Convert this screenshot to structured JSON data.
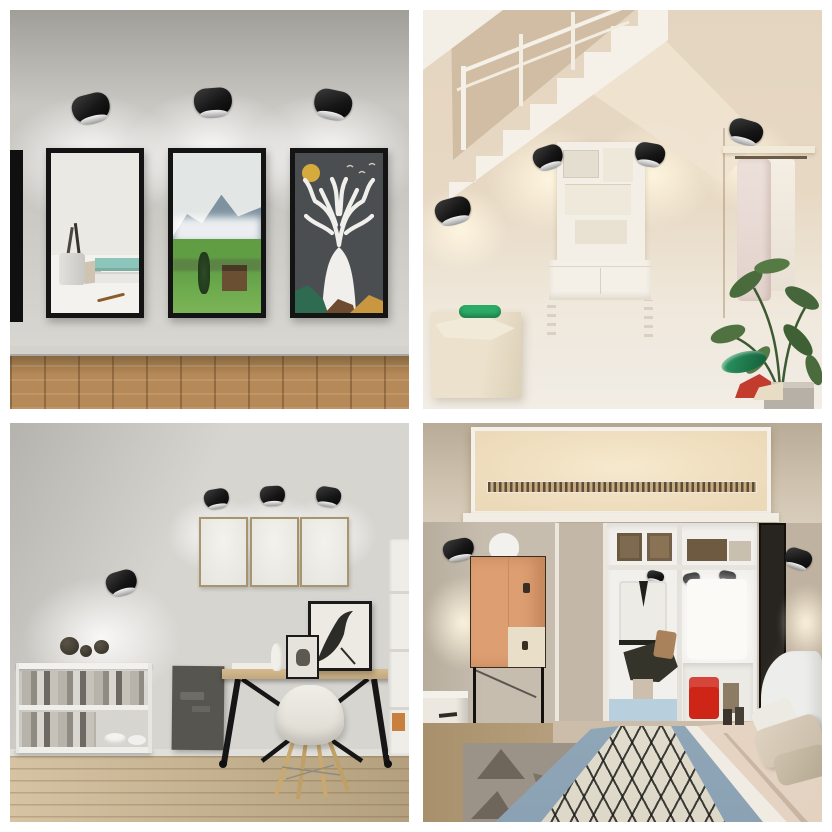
{
  "page": {
    "title": "Wall-mounted black LED spotlights — interior lifestyle photo collage",
    "layout": "2x2 photo grid on white background",
    "text_content": "none — photographic collage with no visible text"
  },
  "palette": {
    "gutter": "#ffffff",
    "frame-black": "#141414",
    "lamp-black": "#161616",
    "q1-wall": "#c9c7c2",
    "q1-wall-light": "#dedcd7",
    "q1-floor": "#b68a58",
    "art1-bg": "#ebe9e4",
    "art1-book-teal": "#8cc5ba",
    "art2-sky": "#e2e6e5",
    "art2-mountain": "#7e92a0",
    "art2-grass": "#61a046",
    "art3-bg": "#4b4e50",
    "art3-deer": "#f0efec",
    "art3-moon": "#d6ab3d",
    "q2-wall": "#e4d5c0",
    "q2-wall-dark": "#d0bda4",
    "q2-stair-white": "#f6f1e8",
    "q2-floor": "#f2ede5",
    "bench-cream": "#ebe1cc",
    "green-cushion": "#2cab66",
    "plant-green": "#4a6c3c",
    "shoe-red": "#c33b2d",
    "q3-wall": "#d7d5d0",
    "q3-frame-border": "#a8946d",
    "q3-floor": "#ccb68f",
    "desk-wood": "#c3a87e",
    "panel-dark": "#56554f",
    "chair-white": "#f0eee8",
    "q4-ceiling-glow": "#f6e9cd",
    "q4-wall-left": "#c6bdaf",
    "closet-white": "#f2f0ec",
    "cabinet-peach": "#dd9f72",
    "bed-blue": "#8ba2b4",
    "bed-lattice-bg": "#e9e3d2",
    "bed-sheet-pink": "#e4d2c1",
    "red-bag": "#cf2517",
    "rug-gray": "#9b9388"
  },
  "quadrants": [
    {
      "id": "gallery-wall",
      "position": "top-left",
      "lamp_count": 3,
      "description": "Gallery wall: three black-framed artworks each lit from above by a black drum wall spotlight, scalloped light on grey wall, parquet wood floor, partial frame at left edge",
      "artworks": [
        "still life with reed-diffuser jar, teal and white books, dried leaf",
        "misty blue mountain landscape with green meadow and wooden cabin",
        "white deer with branching antlers, gold moon and birds on dark grey"
      ]
    },
    {
      "id": "under-stairs-dressing-area",
      "position": "top-right",
      "lamp_count": 4,
      "description": "Beige under-stairs nook: white zig-zag staircase with railing, black wall spotlights with warm glows, white vanity desk with moodboard, fabric bench with green cushion, clothes rail with pale garments, potted plant, red shoes",
      "objects": [
        "staircase",
        "railing",
        "vanity desk",
        "moodboard",
        "bench",
        "green cushion",
        "clothes rail",
        "hanging garments",
        "potted plant",
        "planter",
        "red shoes",
        "green slide"
      ]
    },
    {
      "id": "home-office",
      "position": "bottom-left",
      "lamp_count": 4,
      "description": "Home office: three blank thin-framed canvases under three black spotlights, one spotlight washing light over a low white shelf with books and bowls, dark pinboard, wooden desk on black trestle legs, white shell chair with wooden legs, bird artwork frames, plank wood floor",
      "objects": [
        "blank canvases",
        "wall spheres",
        "low shelf",
        "books",
        "bowls",
        "dark pinboard",
        "desk",
        "bird picture frame",
        "small frame",
        "white vase",
        "shell chair",
        "tall bookcase"
      ]
    },
    {
      "id": "bedroom-closet",
      "position": "bottom-right",
      "lamp_count": 5,
      "description": "Bedroom: recessed warm-lit tray ceiling with fretwork strip, open white wardrobe with storage boxes, hanging jacket, white shirt and red bag lit by black spotlights, peach cabinet on black stand with white bust, white dresser, dark mirror, bed with blue trim and black-on-cream diamond lattice runner, beige pillows, grey rug with triangles",
      "objects": [
        "tray ceiling",
        "fretwork strip",
        "open wardrobe",
        "storage boxes",
        "hanging jacket",
        "white shirt",
        "red bag",
        "blue drawers",
        "peach cabinet",
        "black stand",
        "white bust",
        "dresser",
        "mirror",
        "headboard",
        "pillows",
        "lattice bed runner",
        "rug"
      ]
    }
  ]
}
